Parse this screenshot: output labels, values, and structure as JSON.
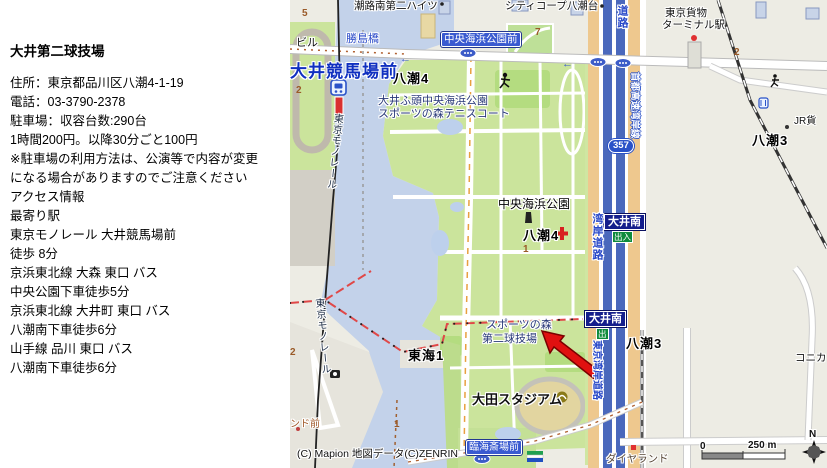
{
  "info_panel": {
    "title": "大井第二球技場",
    "lines": [
      "住所：東京都品川区八潮4-1-19",
      "電話：03-3790-2378",
      "駐車場：収容台数:290台",
      "1時間200円。以降30分ごと100円",
      "※駐車場の利用方法は、公演等で内容が変更",
      "になる場合がありますのでご注意ください",
      "アクセス情報",
      "最寄り駅",
      "東京モノレール 大井競馬場前",
      "徒歩 8分",
      "京浜東北線 大森 東口 バス",
      "中央公園下車徒歩5分",
      "京浜東北線 大井町 東口 バス",
      "八潮南下車徒歩6分",
      "山手線 品川 東口 バス",
      "八潮南下車徒歩6分"
    ]
  },
  "map": {
    "stations": {
      "oi_keibajo_mae": "大井競馬場前"
    },
    "bridges": {
      "katsushima": "勝島橋"
    },
    "bus_stops": {
      "chuo_kaihin_koen_mae": "中央海浜公園前",
      "rinkai_saijo_mae": "臨海斎場前",
      "land_mae_partial": "ンド前"
    },
    "districts": {
      "yashio4": "八潮4",
      "yashio3": "八潮3",
      "tokai1": "東海1"
    },
    "facilities": {
      "park_line1": "大井ふ頭中央海浜公園",
      "park_line2": "スポーツの森テニスコート",
      "chuo_kaihin_koen": "中央海浜公園",
      "venue_line1": "スポーツの森",
      "venue_line2": "第二球技場",
      "ota_stadium": "大田スタジアム",
      "freight_line1": "東京貨物",
      "freight_line2": "ターミナル駅",
      "jr_partial": "JR貨",
      "konica_partial": "コニカミ",
      "diamond_land": "ダイヤランド",
      "shiojiminami_heights": "潮路南第二ハイツ",
      "city_corp_yashio": "シティコープ八潮台",
      "building_partial": "ビル"
    },
    "roads": {
      "route_357": "357",
      "wangan_doro": "湾岸道路",
      "doro_partial": "道路",
      "shuto_expressway": "首都高速湾岸線",
      "tokyo_wangan_doro": "東京湾岸道路",
      "monorail": "東京モノレール",
      "oi_minami": "大井南",
      "exit_in_out": "出入",
      "exit_out": "出",
      "one_way_arrow": "←"
    },
    "numbers": {
      "n5": "5",
      "n2a": "2",
      "n2b": "2",
      "n2c": "2",
      "n7": "7",
      "n1a": "1",
      "n1b": "1"
    },
    "scale": {
      "zero": "0",
      "distance": "250 m",
      "north": "N"
    },
    "copyright": "(C) Mapion 地図データ(C)ZENRIN",
    "colors": {
      "water": "#C3D2EA",
      "park": "#CBE49C",
      "expressway": "#4A68BC",
      "national_road": "#EEC88E",
      "label_blue": "#2848C8",
      "exit_box": "#141E8C",
      "arrow_red": "#E01010"
    }
  }
}
